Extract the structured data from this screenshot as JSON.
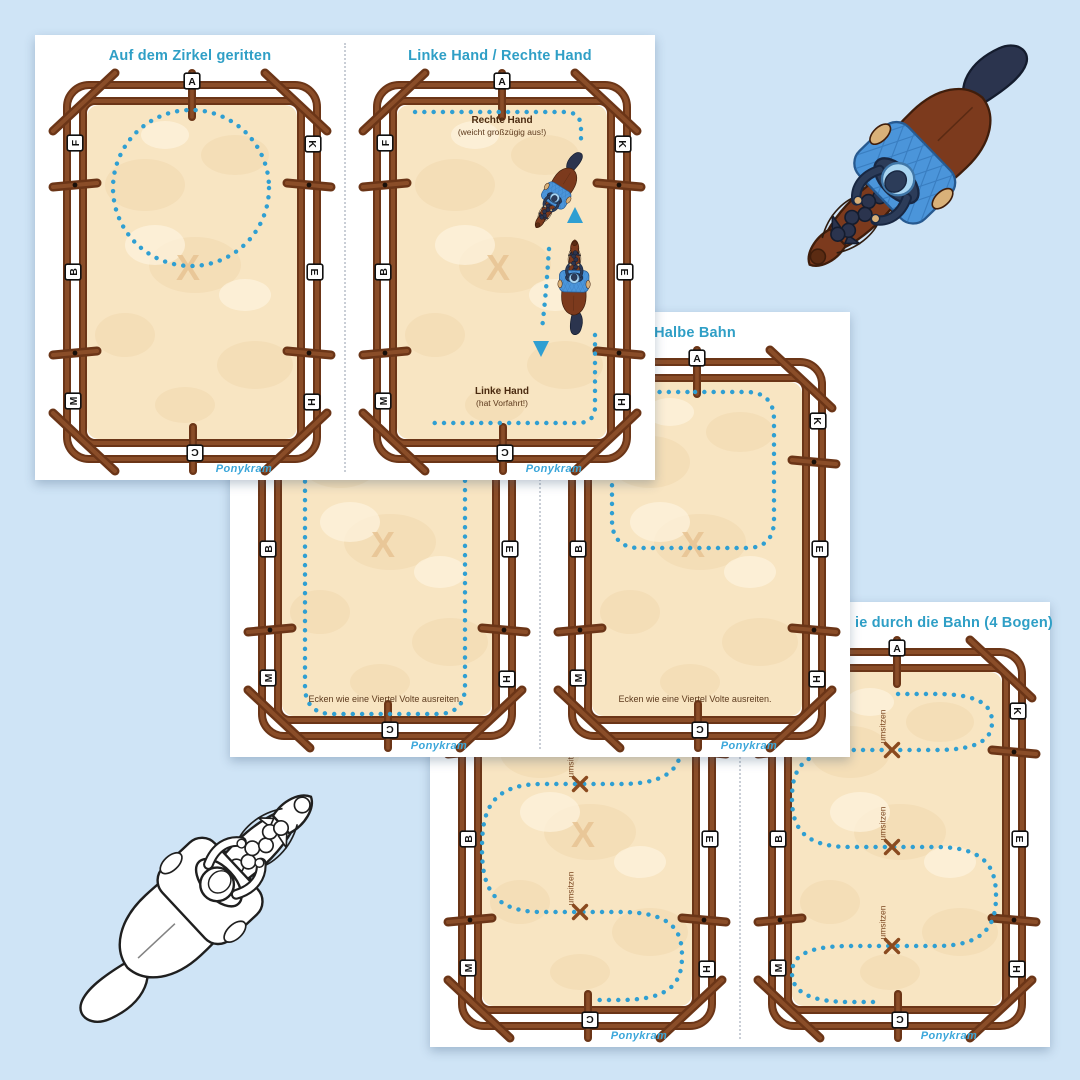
{
  "page": {
    "background": "#cfe4f6"
  },
  "brand": {
    "name": "Ponykram",
    "color": "#3aa6da"
  },
  "arena": {
    "letters": {
      "top": "A",
      "bottom": "C",
      "left": [
        "F",
        "B",
        "M"
      ],
      "right": [
        "K",
        "E",
        "H"
      ]
    },
    "center_mark": "X"
  },
  "cards": {
    "zirkel": {
      "title": "Auf dem Zirkel geritten"
    },
    "haende": {
      "title": "Linke Hand / Rechte Hand",
      "rechte_hand_label": "Rechte Hand",
      "rechte_hand_note": "(weicht großzügig aus!)",
      "linke_hand_label": "Linke Hand",
      "linke_hand_note": "(hat Vorfahrt!)"
    },
    "ganze_bahn": {
      "corner_note": "Ecken wie eine Viertel Volte ausreiten."
    },
    "halbe_bahn": {
      "title": "Halbe Bahn",
      "corner_note": "Ecken wie eine Viertel Volte ausreiten."
    },
    "schlangenlinie_3": {
      "umsitzen_label": "umsitzen"
    },
    "schlangenlinie_4": {
      "title_visible": "ie durch die Bahn (4 Bogen)",
      "umsitzen_label": "umsitzen"
    }
  },
  "colors": {
    "background": "#cfe4f6",
    "card": "#ffffff",
    "title": "#2f9fc6",
    "brand_text": "#3aa6da",
    "path_dots": "#2f9fd2",
    "sand": "#f8e5c2",
    "sand_blotch": "#eed1a2",
    "sand_mark": "#e8c493",
    "fence_dark": "#6b3517",
    "fence_light": "#8a4d28",
    "label_brown": "#4a2a10",
    "note_brown": "#5d3a1d",
    "cross_brown": "#8a4a1f",
    "divider": "#c9ced6"
  },
  "horse_colors": {
    "body": "#7c3a1d",
    "mane": "#2b344e",
    "saddle_pad": "#4b95da",
    "rider_jacket": "#2c3c59",
    "helmet": "#aad6f2",
    "muzzle": "#5b2b12",
    "skin": "#d9b179"
  }
}
